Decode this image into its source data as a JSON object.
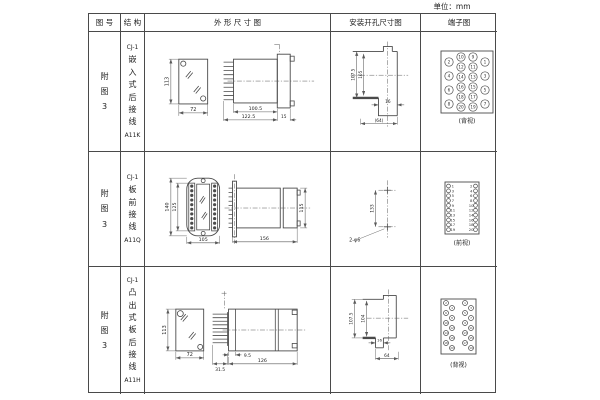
{
  "page": {
    "unit_label": "单位：mm"
  },
  "table": {
    "headers": {
      "col1": "图 号",
      "col2": "结 构",
      "col3": "外 形 尺 寸 图",
      "col4": "安装开孔尺寸图",
      "col5": "端子图"
    },
    "rows": [
      {
        "figure_no": "附图3",
        "model": "CJ-1",
        "mount_desc": "嵌入式后接线",
        "code": "A11K",
        "outline": {
          "front_height": "113",
          "front_width": "72",
          "body_length": "100.5",
          "total_length": "122.5",
          "flange": "15"
        },
        "mounting": {
          "height_outer": "107.5",
          "height_inner": "105",
          "slot_width": "16",
          "span": "(64)"
        },
        "terminal": {
          "view_label": "(背视)",
          "numbers": [
            2,
            4,
            6,
            8,
            10,
            12,
            14,
            16,
            18,
            20,
            9,
            11,
            13,
            15,
            17,
            19,
            1,
            3,
            5,
            7
          ]
        }
      },
      {
        "figure_no": "附图3",
        "model": "CJ-1",
        "mount_desc": "板前接线",
        "code": "A11Q",
        "outline": {
          "front_height_outer": "140",
          "front_height_inner": "125",
          "front_width": "105",
          "side_length": "156",
          "side_height": "115"
        },
        "mounting": {
          "hole_span": "133",
          "hole_note": "2-φ6"
        },
        "terminal": {
          "view_label": "(前视)",
          "left_numbers": [
            1,
            3,
            5,
            7,
            9,
            11,
            13,
            15,
            17,
            19
          ],
          "right_numbers": [
            2,
            4,
            6,
            8,
            10,
            12,
            14,
            16,
            18,
            20
          ]
        }
      },
      {
        "figure_no": "附图3",
        "model": "CJ-1",
        "mount_desc": "凸出式板后接线",
        "code": "A11H",
        "outline": {
          "front_height": "113",
          "front_width": "72",
          "pin_length": "31.5",
          "gap": "9.5",
          "body_length": "126"
        },
        "mounting": {
          "height_outer": "107.5",
          "height_inner": "104",
          "slot_width": "16",
          "span": "64"
        },
        "terminal": {
          "view_label": "(背视)",
          "numbers": [
            2,
            6,
            10,
            14,
            18,
            4,
            8,
            12,
            16,
            20,
            1,
            5,
            9,
            13,
            17,
            3,
            7,
            11,
            15,
            19
          ]
        }
      }
    ]
  }
}
